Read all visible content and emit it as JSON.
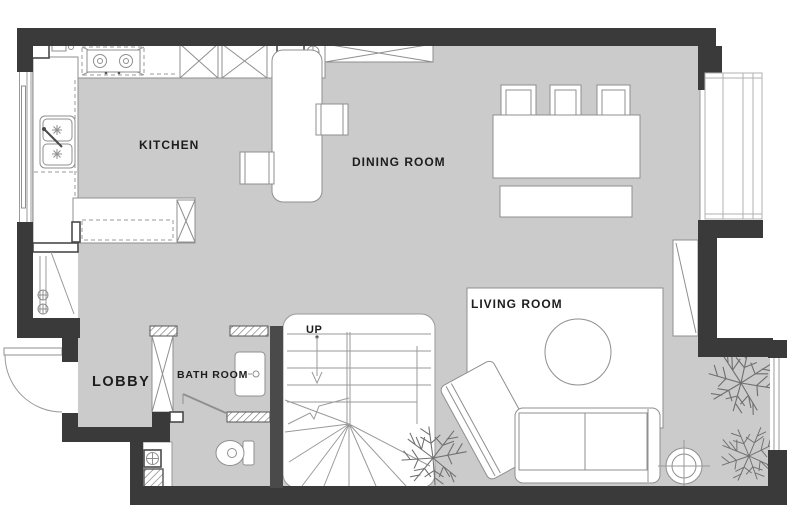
{
  "title": "Apartment floor plan",
  "labels": {
    "kitchen": "KITCHEN",
    "dining_room": "DINING ROOM",
    "living_room": "LIVING ROOM",
    "lobby": "LOBBY",
    "bath_room": "BATH ROOM",
    "stairs_up": "UP"
  },
  "colors": {
    "wall": "#3a3a3a",
    "stair_wall": "#4a4a4a",
    "floor": "#cbcbcb",
    "furniture_outline": "#8f8f8f",
    "label_text": "#1d1d1d",
    "background": "#ffffff"
  }
}
